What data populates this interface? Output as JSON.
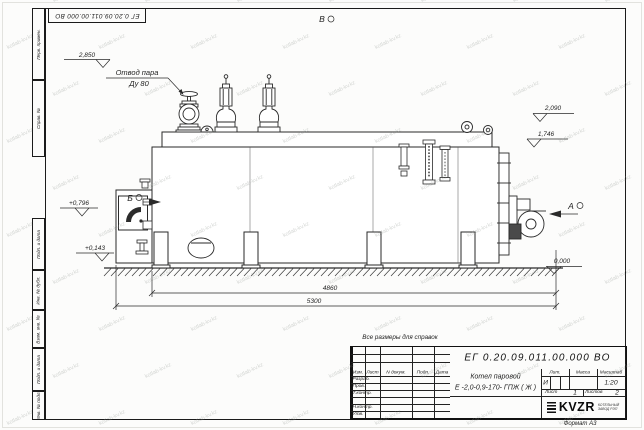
{
  "watermark": {
    "text": "kotlab-kv.kz"
  },
  "frame": {
    "top_stamp": "ЕГ 0.20.09.011.00.000  ВО",
    "side_top": [
      "Перв. примен.",
      "Справ. №"
    ],
    "side_bottom": [
      "Подп. и дата",
      "Инв. № дубл.",
      "Взам. инв. №",
      "Подп. и дата",
      "Инв. № подл."
    ],
    "format_note": "Формат А3"
  },
  "drawing": {
    "reference_note": "Все размеры для справок",
    "steam_outlet": {
      "line1": "Отвод пара",
      "line2": "Ду 80"
    },
    "views": {
      "a": "А",
      "b": "Б",
      "v": "В"
    },
    "elevations": {
      "top": "2,850",
      "casing": "2,090",
      "drum": "1,746",
      "door": "+0,796",
      "base": "+0,143",
      "ground": "0,000"
    },
    "dimensions": {
      "length_body": "4860",
      "length_total": "5300"
    }
  },
  "title_block": {
    "doc_number": "ЕГ 0.20.09.011.00.000  ВО",
    "product_name_line1": "Котел паровой",
    "product_name_line2": "Е -2,0-0,9-170- ГПЖ ( Ж )",
    "col_izm": "Изм.",
    "col_list": "Лист",
    "col_ndoc": "N докум.",
    "col_podp": "Подп.",
    "col_data": "Дата",
    "row_razrab": "Разраб.",
    "row_prov": "Пров.",
    "row_tkontr": "Т.контр.",
    "row_nkontr": "Н.контр.",
    "row_utv": "Утв.",
    "lit_header": "Лит.",
    "mass_header": "Масса",
    "scale_header": "Масштаб",
    "lit_value": "И",
    "scale_value": "1:20",
    "sheet_label": "Лист",
    "sheet_value": "1",
    "sheets_label": "Листов",
    "sheets_value": "2",
    "logo_text": "KVZR",
    "logo_sub_line1": "КОТЕЛЬНЫЙ",
    "logo_sub_line2": "ЗАВОД РЭП"
  }
}
